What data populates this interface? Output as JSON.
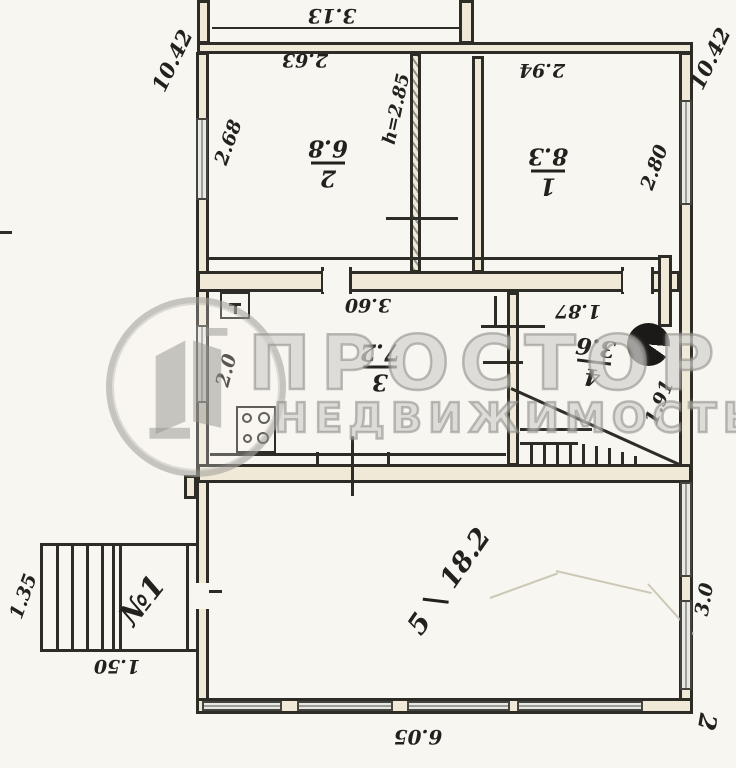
{
  "watermark": {
    "brand": "ПРОСТОР",
    "subtitle": "НЕДВИЖИМОСТЬ"
  },
  "rooms": {
    "r1": {
      "number": "1",
      "area": "8.3"
    },
    "r2": {
      "number": "2",
      "area": "6.8"
    },
    "r3": {
      "number": "3",
      "area": "7.2"
    },
    "r4": {
      "number": "4",
      "area": "3.6"
    },
    "r5": {
      "number": "5",
      "area": "18.2"
    }
  },
  "dimensions": {
    "left_height_total": "10.42",
    "right_height_total": "10.42",
    "top_extension_width": "3.13",
    "room2_width": "2.63",
    "room2_side": "2.68",
    "ceiling_height": "h=2.85",
    "room1_width": "2.94",
    "room1_side": "2.80",
    "kitchen_width": "3.60",
    "kitchen_window_width": "2.0",
    "room4_width": "1.87",
    "room4_side": "1.91",
    "room5_side_width": "3.0",
    "room5_width": "6.05",
    "porch_side": "1.35",
    "porch_width": "1.50"
  },
  "annotations": {
    "porch_number": "№1",
    "corner_mark": "2"
  },
  "icons": {
    "stove": "4-burner-stove",
    "sink": "sink",
    "boiler": "round-boiler",
    "stairs": "interior-staircase",
    "porch_steps": "entrance-steps"
  },
  "colors": {
    "ink": "#23211d",
    "paper": "#f8f6f1",
    "watermark_gray": "#969490",
    "window_fill": "#e8e9e4",
    "wall_fill": "#f0e9d8"
  }
}
